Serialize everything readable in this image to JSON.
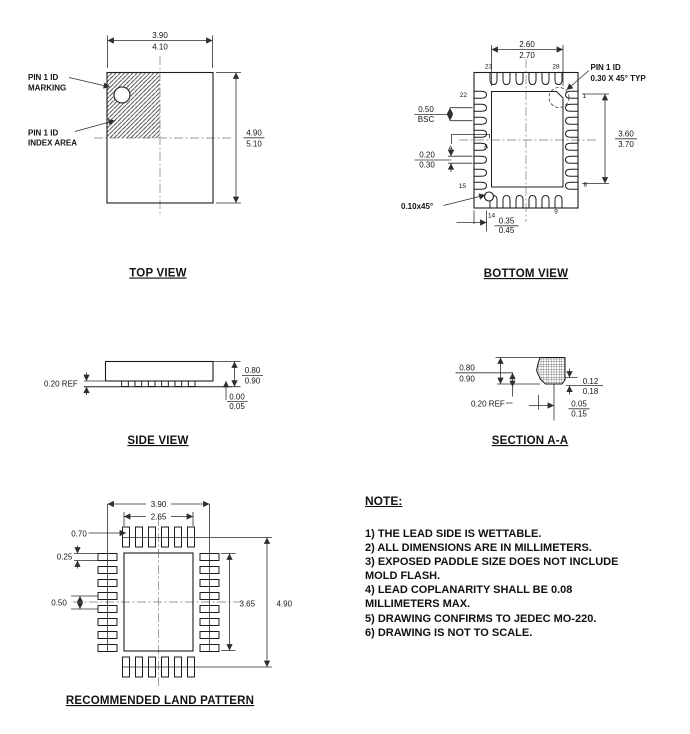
{
  "colors": {
    "ink": "#1a1a1a",
    "background": "#ffffff"
  },
  "drawing": {
    "top_view": {
      "title": "TOP VIEW",
      "pin1_marking_label": [
        "PIN 1 ID",
        "MARKING"
      ],
      "pin1_index_label": [
        "PIN 1 ID",
        "INDEX AREA"
      ],
      "dim_width": [
        "3.90",
        "4.10"
      ],
      "dim_height": [
        "4.90",
        "5.10"
      ]
    },
    "bottom_view": {
      "title": "BOTTOM VIEW",
      "pin1_label": [
        "PIN 1 ID",
        "0.30 X 45° TYP"
      ],
      "chamfer_label": "0.10x45°",
      "dim_paddle_width": [
        "2.60",
        "2.70"
      ],
      "dim_paddle_height": [
        "3.60",
        "3.70"
      ],
      "dim_pitch": [
        "0.50",
        "BSC"
      ],
      "dim_lead_width": [
        "0.20",
        "0.30"
      ],
      "dim_lead_length": [
        "0.35",
        "0.45"
      ],
      "section_label": "A",
      "pins": {
        "p23": "23",
        "p28": "28",
        "p22": "22",
        "p15": "15",
        "p14": "14",
        "p9": "9",
        "p1": "1",
        "p8": "8"
      }
    },
    "side_view": {
      "title": "SIDE VIEW",
      "dim_lead_thickness": "0.20 REF",
      "dim_height": [
        "0.80",
        "0.90"
      ],
      "dim_standoff": [
        "0.00",
        "0.05"
      ]
    },
    "section_aa": {
      "title": "SECTION A-A",
      "dim_height": [
        "0.80",
        "0.90"
      ],
      "dim_ref": "0.20 REF",
      "dim_tip_thickness": [
        "0.12",
        "0.18"
      ],
      "dim_foot": [
        "0.05",
        "0.15"
      ]
    },
    "land_pattern": {
      "title": "RECOMMENDED LAND PATTERN",
      "dim_width": "3.90",
      "dim_inner_width": "2.65",
      "dim_pad_length": "0.70",
      "dim_pad_width": "0.25",
      "dim_pitch": "0.50",
      "dim_inner_height": "3.65",
      "dim_height": "4.90"
    },
    "notes": {
      "heading": "NOTE:",
      "lines": [
        "1) THE LEAD SIDE IS WETTABLE.",
        "2) ALL DIMENSIONS ARE IN MILLIMETERS.",
        "3) EXPOSED PADDLE SIZE DOES NOT INCLUDE",
        "MOLD FLASH.",
        "4) LEAD COPLANARITY SHALL BE 0.08",
        "MILLIMETERS MAX.",
        "5) DRAWING CONFIRMS TO JEDEC MO-220.",
        "6) DRAWING IS NOT TO SCALE."
      ]
    }
  }
}
